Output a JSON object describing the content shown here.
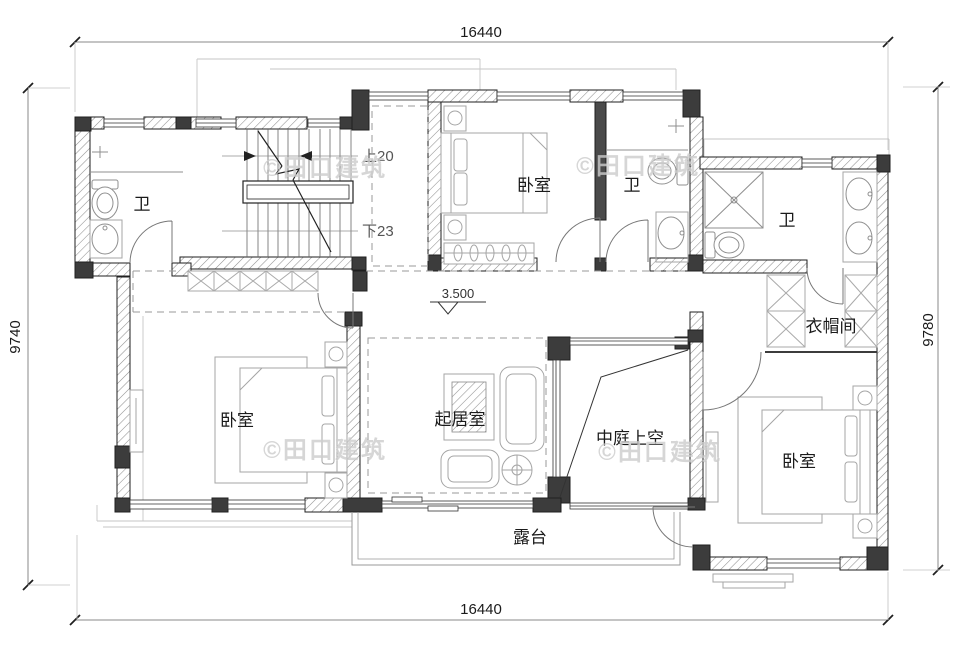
{
  "dimensions": {
    "top": "16440",
    "bottom": "16440",
    "left": "9740",
    "right": "9780"
  },
  "rooms": {
    "bath_left": "卫",
    "bedroom_top": "卧室",
    "bath_middle": "卫",
    "bath_right": "卫",
    "cloakroom": "衣帽间",
    "bedroom_left": "卧室",
    "living_room": "起居室",
    "atrium": "中庭上空",
    "bedroom_right": "卧室",
    "terrace": "露台"
  },
  "stairs": {
    "up_label": "上20",
    "down_label": "下23"
  },
  "level_mark": "3.500",
  "watermark": "©田口建筑",
  "colors": {
    "column": "#3c3c3c",
    "wall_line": "#1f1f1f",
    "watermark": "#cdcdcd"
  }
}
